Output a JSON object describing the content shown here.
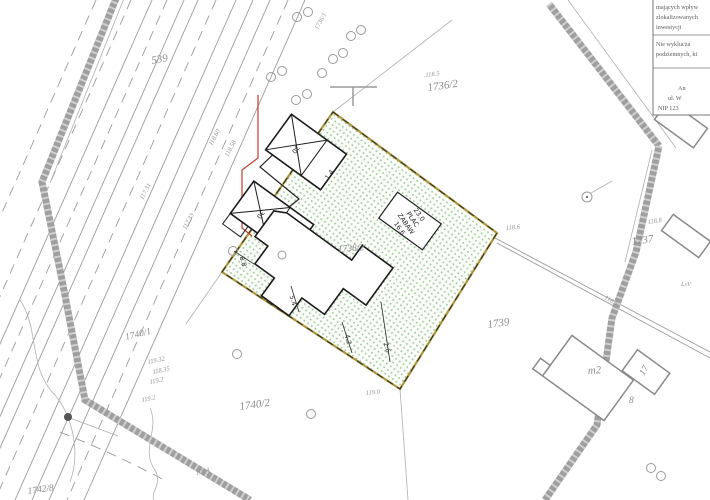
{
  "map_labels": {
    "road_parcel": "539",
    "road_strip_parcel": "1736/1",
    "parcel_top": "1736/2",
    "parcel_top_elev": ".118.5",
    "parcel_right": "1737",
    "parcel_right_elev": "118.8",
    "site_parcel": "1738/2",
    "parcel_south": "1739",
    "parcel_sw": "1740/2",
    "parcel_w": "1740/1",
    "parcel_bl": "1742/8",
    "forest_class": "LsV"
  },
  "elevations": {
    "e_track_w": "118.6",
    "e_track_e": "118.5",
    "e_bottom": "119.0",
    "e_sw1": "119.32",
    "e_sw2": "118.35",
    "e_sw3": "119.2",
    "e_sw4": "119.2",
    "e_sw5": "119.4",
    "e_road1": "117.31",
    "e_road2": "117.33",
    "e_road3": "118.60",
    "e_road4": "118.58"
  },
  "dimensions": {
    "d_88": "8.8",
    "d_54": "5.4",
    "d_42": "4.2",
    "d_26": "2.6",
    "d_14": "1.4",
    "d_9": "9"
  },
  "buildings": {
    "demolish_a": "30",
    "demolish_b": "30",
    "house": "m2",
    "house_num": "8",
    "annex": "17"
  },
  "playground": {
    "dim_a": "23.0",
    "word1": "PLAC",
    "word2": "ZABAW",
    "dim_b": "16.6"
  },
  "stamp": {
    "l1": "mających wpływ",
    "l2": "zlokalizowanych",
    "l3": "inwestycji",
    "l4": "Nie wyklucza",
    "l5": "podziemnych, kt",
    "l6": "An",
    "l7": "ul. W",
    "l8": "NIP 123"
  },
  "colors": {
    "site_border": "#ad973b",
    "site_dots": "#9ec79b",
    "boundary_band": "#9f9f9f",
    "utility_red": "#c23a2e"
  }
}
